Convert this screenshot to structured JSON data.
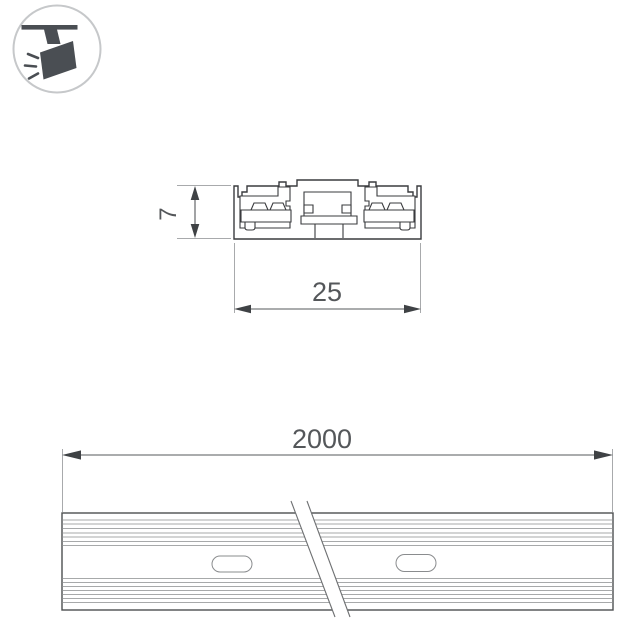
{
  "colors": {
    "background": "#ffffff",
    "profile_outline": "#3a3b3e",
    "dimension_line": "#55585b",
    "dimension_text": "#54575a",
    "extension_line": "#a8aaac",
    "rib_line": "#8a8c8e",
    "icon_fill": "#4a4e53",
    "icon_circle_border": "#c6c8ca"
  },
  "icon": {
    "name": "track-spotlight-icon",
    "description": "ceiling track spotlight glyph inside circle badge"
  },
  "cross_section_view": {
    "height_dimension": {
      "label": "7",
      "orientation": "vertical"
    },
    "width_dimension": {
      "label": "25",
      "orientation": "horizontal"
    },
    "features": {
      "conductor_slots": 2,
      "center_channel": 1
    }
  },
  "length_view": {
    "length_dimension": {
      "label": "2000",
      "orientation": "horizontal"
    },
    "mounting_slots": 2,
    "has_break_symbol": true
  }
}
